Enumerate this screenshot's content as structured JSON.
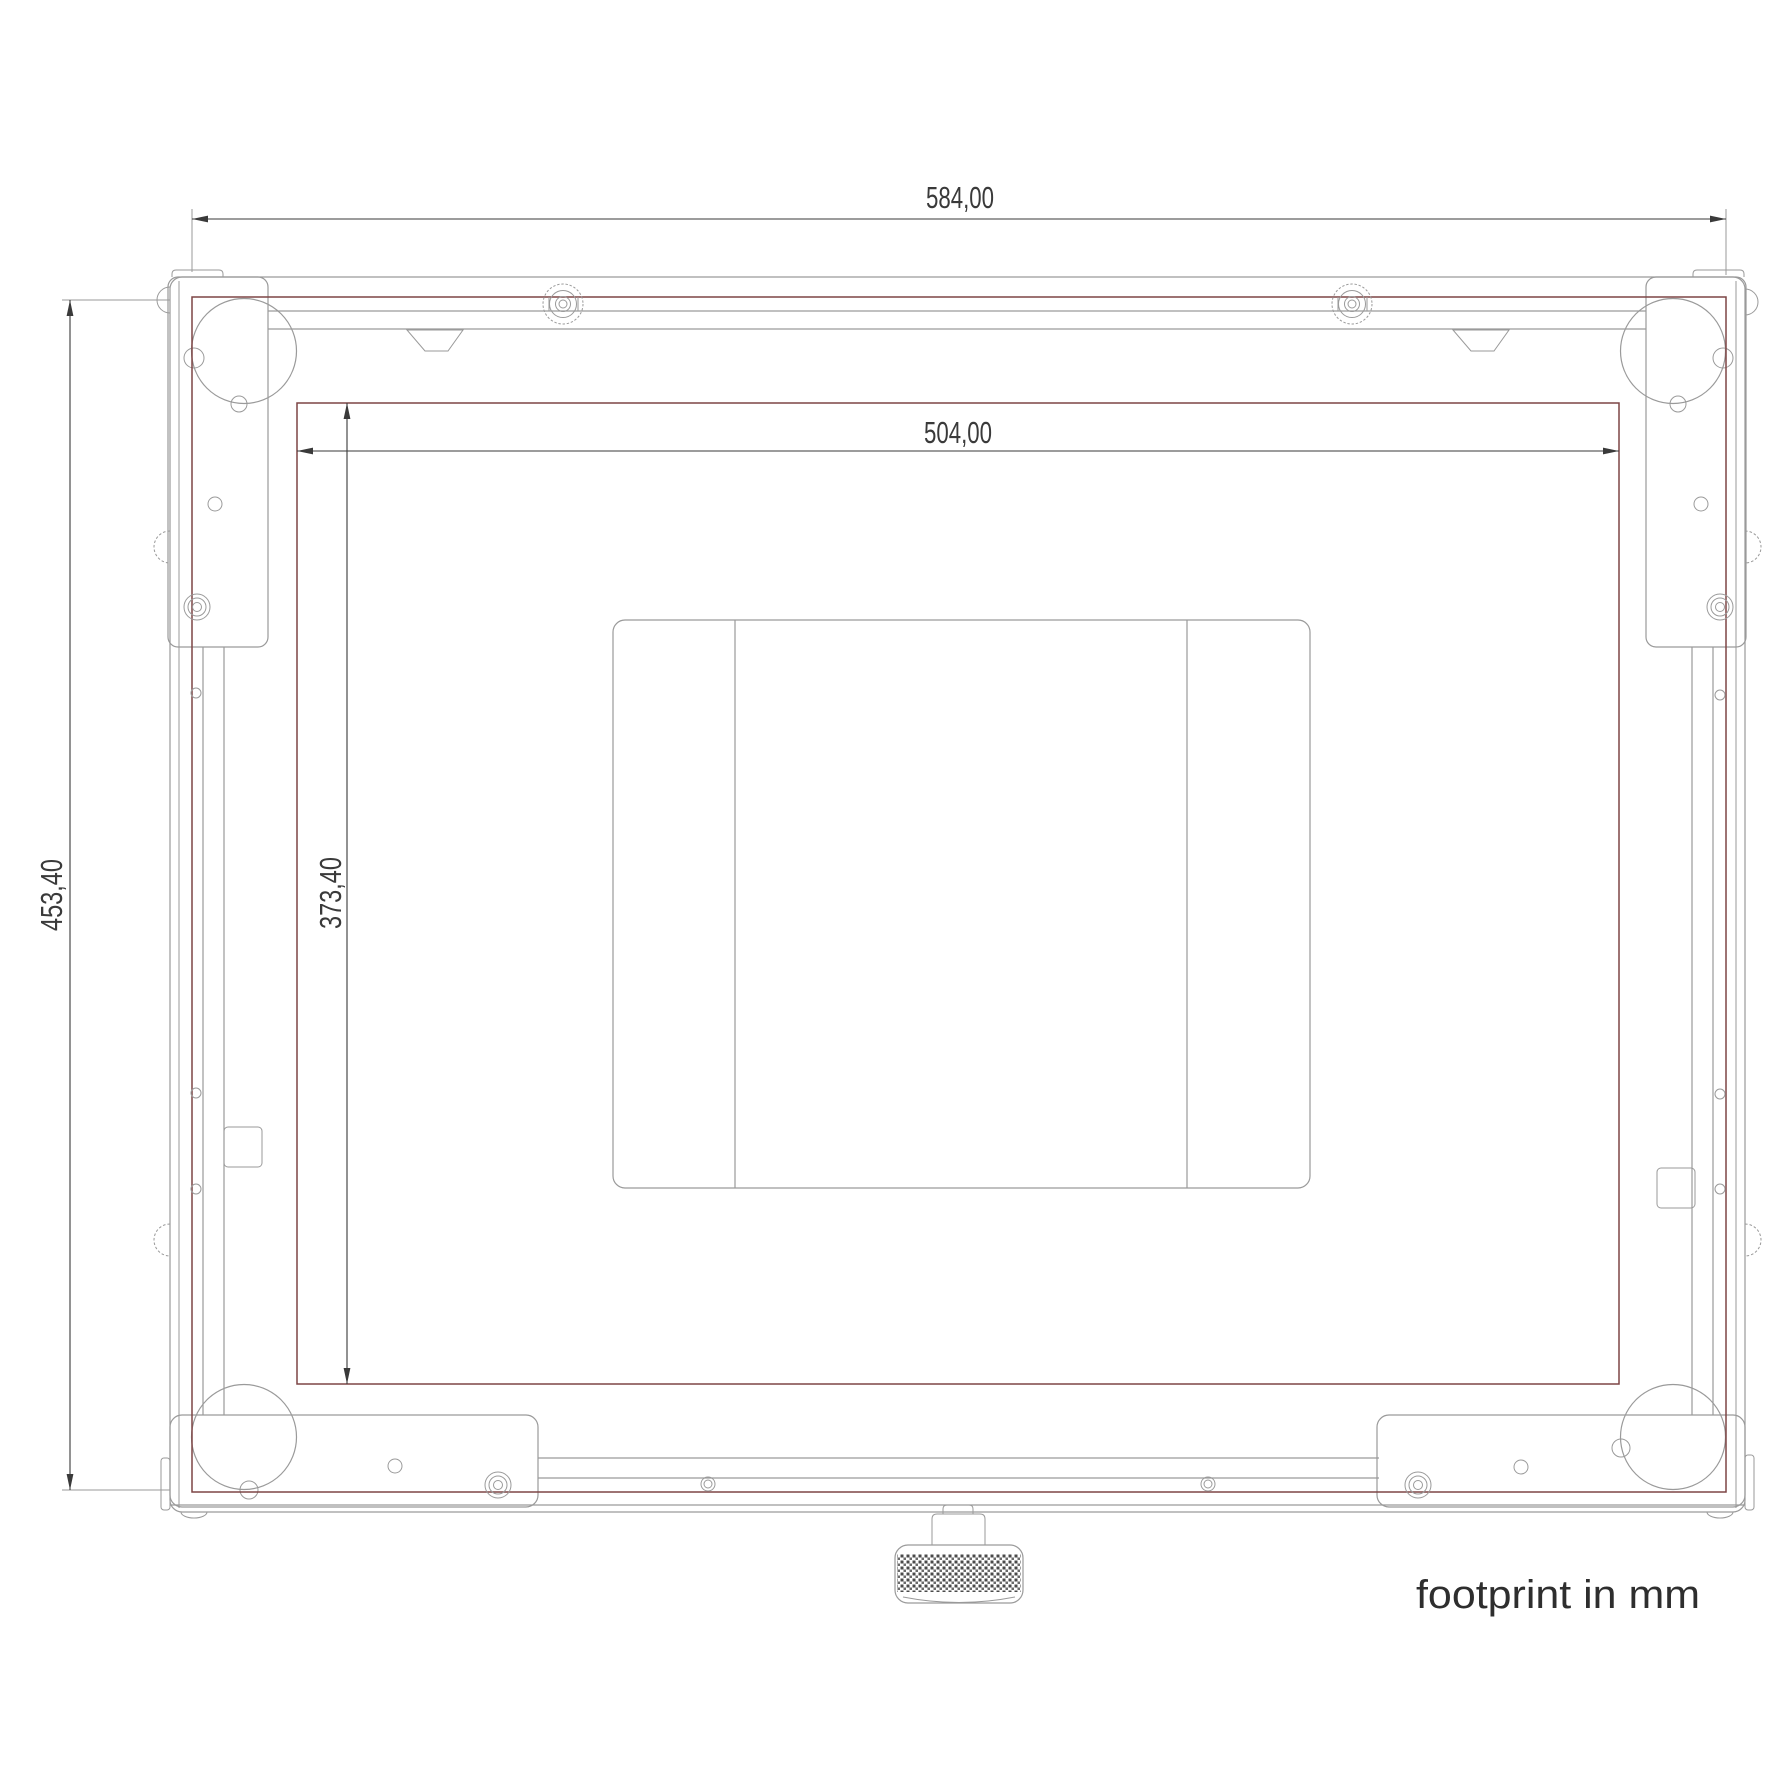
{
  "drawing": {
    "title": "footprint in mm",
    "unit": "mm",
    "dimensions": {
      "outer_width": "584,00",
      "inner_width": "504,00",
      "outer_height": "453,40",
      "inner_height": "373,40"
    },
    "colors": {
      "background": "#ffffff",
      "outline": "#9a9a9a",
      "footprint": "#7d4545",
      "dimension": "#3a3a3a"
    }
  }
}
